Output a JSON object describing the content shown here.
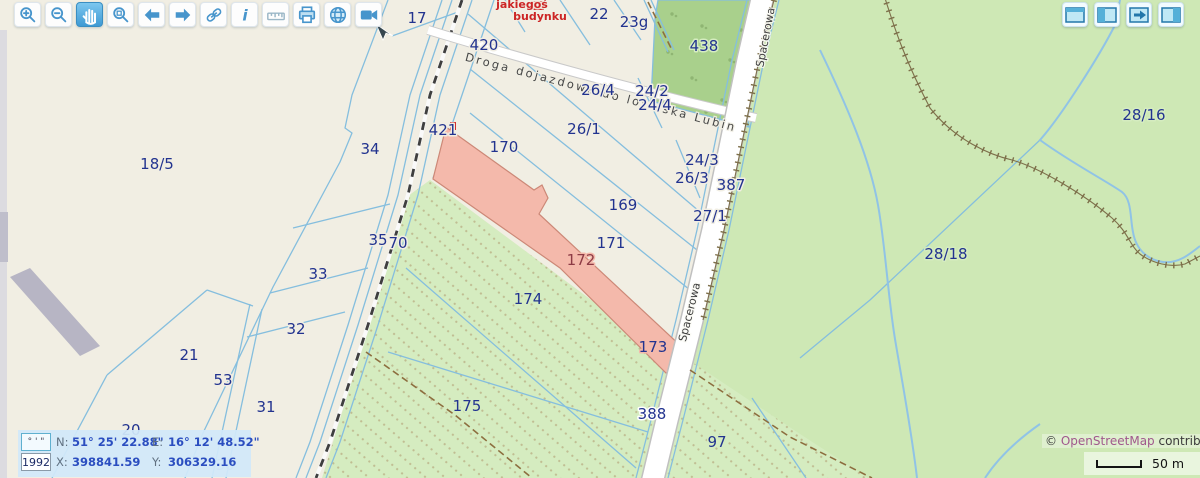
{
  "toolbar": {
    "buttons": [
      {
        "name": "zoom-in",
        "icon": "magnifier-plus-icon"
      },
      {
        "name": "zoom-out",
        "icon": "magnifier-minus-icon"
      },
      {
        "name": "pan",
        "icon": "hand-icon",
        "active": true
      },
      {
        "name": "zoom-selection",
        "icon": "magnifier-box-icon"
      },
      {
        "name": "previous-view",
        "icon": "arrow-left-icon"
      },
      {
        "name": "next-view",
        "icon": "arrow-right-icon"
      },
      {
        "name": "link",
        "icon": "chain-icon"
      },
      {
        "name": "info",
        "icon": "info-icon",
        "glyph": "i"
      },
      {
        "name": "measure",
        "icon": "ruler-icon"
      },
      {
        "name": "print",
        "icon": "printer-icon"
      },
      {
        "name": "globe",
        "icon": "globe-icon"
      },
      {
        "name": "video",
        "icon": "camera-icon"
      }
    ]
  },
  "panel_toggles": [
    {
      "name": "map-window",
      "icon": "window-icon"
    },
    {
      "name": "left-panel",
      "icon": "panel-left-icon"
    },
    {
      "name": "expand-panel",
      "icon": "panel-arrow-icon"
    },
    {
      "name": "right-panel",
      "icon": "panel-right-icon"
    }
  ],
  "map": {
    "parcels": [
      {
        "label": "17"
      },
      {
        "label": "420"
      },
      {
        "label": "22"
      },
      {
        "label": "23g"
      },
      {
        "label": "438"
      },
      {
        "label": "26/4"
      },
      {
        "label": "24/2"
      },
      {
        "label": "24/4"
      },
      {
        "label": "26/1"
      },
      {
        "label": "421"
      },
      {
        "label": "170"
      },
      {
        "label": "24/3"
      },
      {
        "label": "26/3"
      },
      {
        "label": "387"
      },
      {
        "label": "18/5"
      },
      {
        "label": "34"
      },
      {
        "label": "169"
      },
      {
        "label": "27/1"
      },
      {
        "label": "171"
      },
      {
        "label": "35"
      },
      {
        "label": "70"
      },
      {
        "label": "172"
      },
      {
        "label": "33"
      },
      {
        "label": "28/18"
      },
      {
        "label": "28/16"
      },
      {
        "label": "174"
      },
      {
        "label": "32"
      },
      {
        "label": "21"
      },
      {
        "label": "53"
      },
      {
        "label": "173"
      },
      {
        "label": "31"
      },
      {
        "label": "20"
      },
      {
        "label": "175"
      },
      {
        "label": "388"
      },
      {
        "label": "97"
      },
      {
        "label": "30"
      }
    ],
    "streets": [
      {
        "label": "Spacerowa"
      },
      {
        "label": "Spacerowa"
      }
    ],
    "road_label": "Droga dojazdowa do lotniska Lubin",
    "annotation": {
      "line1": "jakiegoś",
      "line2": "budynku"
    }
  },
  "coords": {
    "dms_box": "° ' \"",
    "epsg_box": "1992",
    "n_label": "N:",
    "n_value": "51° 25' 22.88\"",
    "e_label": "E:",
    "e_value": "16° 12' 48.52\"",
    "x_label": "X:",
    "x_value": "398841.59",
    "y_label": "Y:",
    "y_value": "306329.16"
  },
  "attribution": {
    "symbol": "©",
    "link": "OpenStreetMap",
    "suffix": " contributors"
  },
  "scalebar": {
    "label": "50 m"
  },
  "colors": {
    "background": "#f1eee3",
    "forest": "#cee8b5",
    "scrub": "#a9d08c",
    "orchard_dot": "#c0bd92",
    "selection_pink": "#f4b9ab",
    "cadastral_line": "#85bede",
    "parcel_text": "#22338f",
    "selection_text": "#8d3b45",
    "annotation_red": "#cc2525",
    "stream": "#90c3e6",
    "toolbar_icon_blue": "#4795cc"
  }
}
